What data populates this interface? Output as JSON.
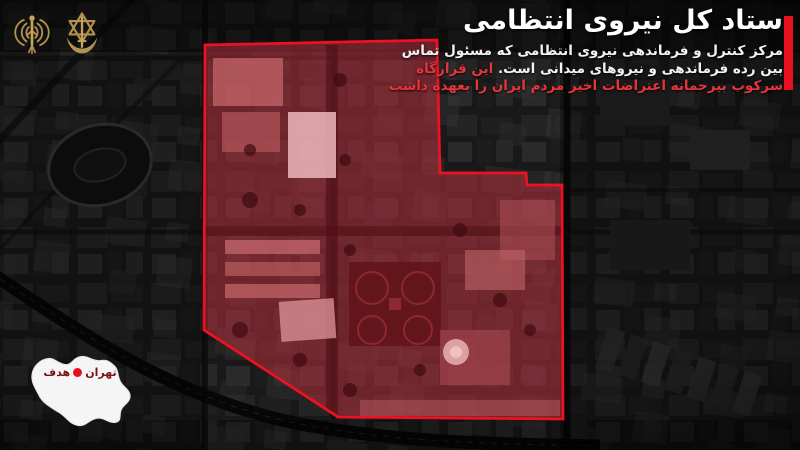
{
  "headline": {
    "title": "ستاد کل نیروی انتظامی",
    "desc_line1": "مرکز کنترل و فرماندهی نیروی انتظامی که مسئول تماس",
    "desc_line2": "بین رده فرماندهی و نیروهای میدانی است.",
    "desc_line2_highlight": "این قرارگاه",
    "desc_line3_highlight": "سرکوب بیرحمانه اعتراضات اخیر مردم ایران را بعهده داشت",
    "text_color": "#ffffff",
    "highlight_color": "#e8343c",
    "accent_bar_color": "#e8101e"
  },
  "emblems": {
    "left_icon": "radio-waves-antenna-emblem",
    "right_icon": "idf-star-sword-emblem",
    "color": "#b3914f"
  },
  "target_zone": {
    "outline_color": "#ee1122",
    "fill_tint": "rgba(156,36,48,0.5)"
  },
  "map_inset": {
    "city_label": "تهران",
    "target_label": "هدف",
    "label_color": "#7d1216",
    "marker_color": "#e8101e",
    "map_fill": "#f5f5f5"
  }
}
